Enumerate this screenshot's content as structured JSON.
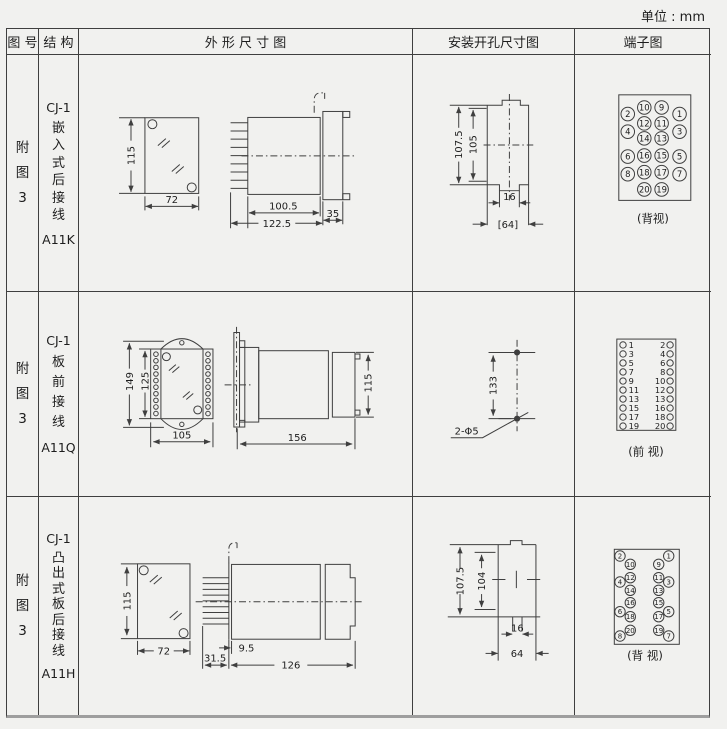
{
  "page": {
    "unit_label": "单位 : mm"
  },
  "table": {
    "headers": {
      "fig": "图 号",
      "struct": "结 构",
      "outline": "外 形 尺 寸 图",
      "mounting": "安装开孔尺寸图",
      "terminal": "端子图"
    }
  },
  "rows": [
    {
      "fig_chars": [
        "附",
        "图",
        "3"
      ],
      "model": "CJ-1",
      "struct_chars": [
        "嵌",
        "入",
        "式",
        "后",
        "接",
        "线"
      ],
      "code": "A11K",
      "outline": {
        "front_height": "115",
        "front_width": "72",
        "body_len": "100.5",
        "total_len": "122.5",
        "flange_len": "35"
      },
      "mounting": {
        "outer_height": "107.5",
        "inner_height": "105",
        "notch_width": "16",
        "cutout_width": "[64]"
      },
      "terminal": {
        "view_label": "(背视)",
        "inner_pairs": [
          [
            "10",
            "9"
          ],
          [
            "12",
            "11"
          ],
          [
            "14",
            "13"
          ],
          [
            "16",
            "15"
          ],
          [
            "18",
            "17"
          ],
          [
            "20",
            "19"
          ]
        ],
        "outer_pairs": [
          [
            "2",
            "1"
          ],
          [
            "4",
            "3"
          ],
          [
            "6",
            "5"
          ],
          [
            "8",
            "7"
          ]
        ]
      }
    },
    {
      "fig_chars": [
        "附",
        "图",
        "3"
      ],
      "model": "CJ-1",
      "struct_chars": [
        "板",
        "前",
        "接",
        "线"
      ],
      "code": "A11Q",
      "outline": {
        "front_height_outer": "149",
        "front_height_inner": "125",
        "front_width": "105",
        "side_length": "156",
        "side_height": "115"
      },
      "mounting": {
        "hole_spacing": "133",
        "hole_note": "2-Φ5"
      },
      "terminal": {
        "view_label": "(前 视)",
        "left_nums": [
          "1",
          "3",
          "5",
          "7",
          "9",
          "11",
          "13",
          "15",
          "17",
          "19"
        ],
        "right_nums": [
          "2",
          "4",
          "6",
          "8",
          "10",
          "12",
          "13",
          "16",
          "18",
          "20"
        ]
      }
    },
    {
      "fig_chars": [
        "附",
        "图",
        "3"
      ],
      "model": "CJ-1",
      "struct_chars": [
        "凸",
        "出",
        "式",
        "板",
        "后",
        "接",
        "线"
      ],
      "code": "A11H",
      "outline": {
        "front_height": "115",
        "front_width": "72",
        "plate_offset": "9.5",
        "pin_len": "31.5",
        "body_len": "126"
      },
      "mounting": {
        "outer_height": "107.5",
        "inner_height": "104",
        "notch_width": "16",
        "cutout_width": "64"
      },
      "terminal": {
        "view_label": "(背 视)",
        "inner_pairs": [
          [
            "10",
            "9"
          ],
          [
            "12",
            "11"
          ],
          [
            "14",
            "13"
          ],
          [
            "16",
            "15"
          ],
          [
            "18",
            "17"
          ],
          [
            "20",
            "19"
          ]
        ],
        "outer_pairs": [
          [
            "2",
            "1"
          ],
          [
            "4",
            "3"
          ],
          [
            "6",
            "5"
          ],
          [
            "8",
            "7"
          ]
        ]
      }
    }
  ]
}
